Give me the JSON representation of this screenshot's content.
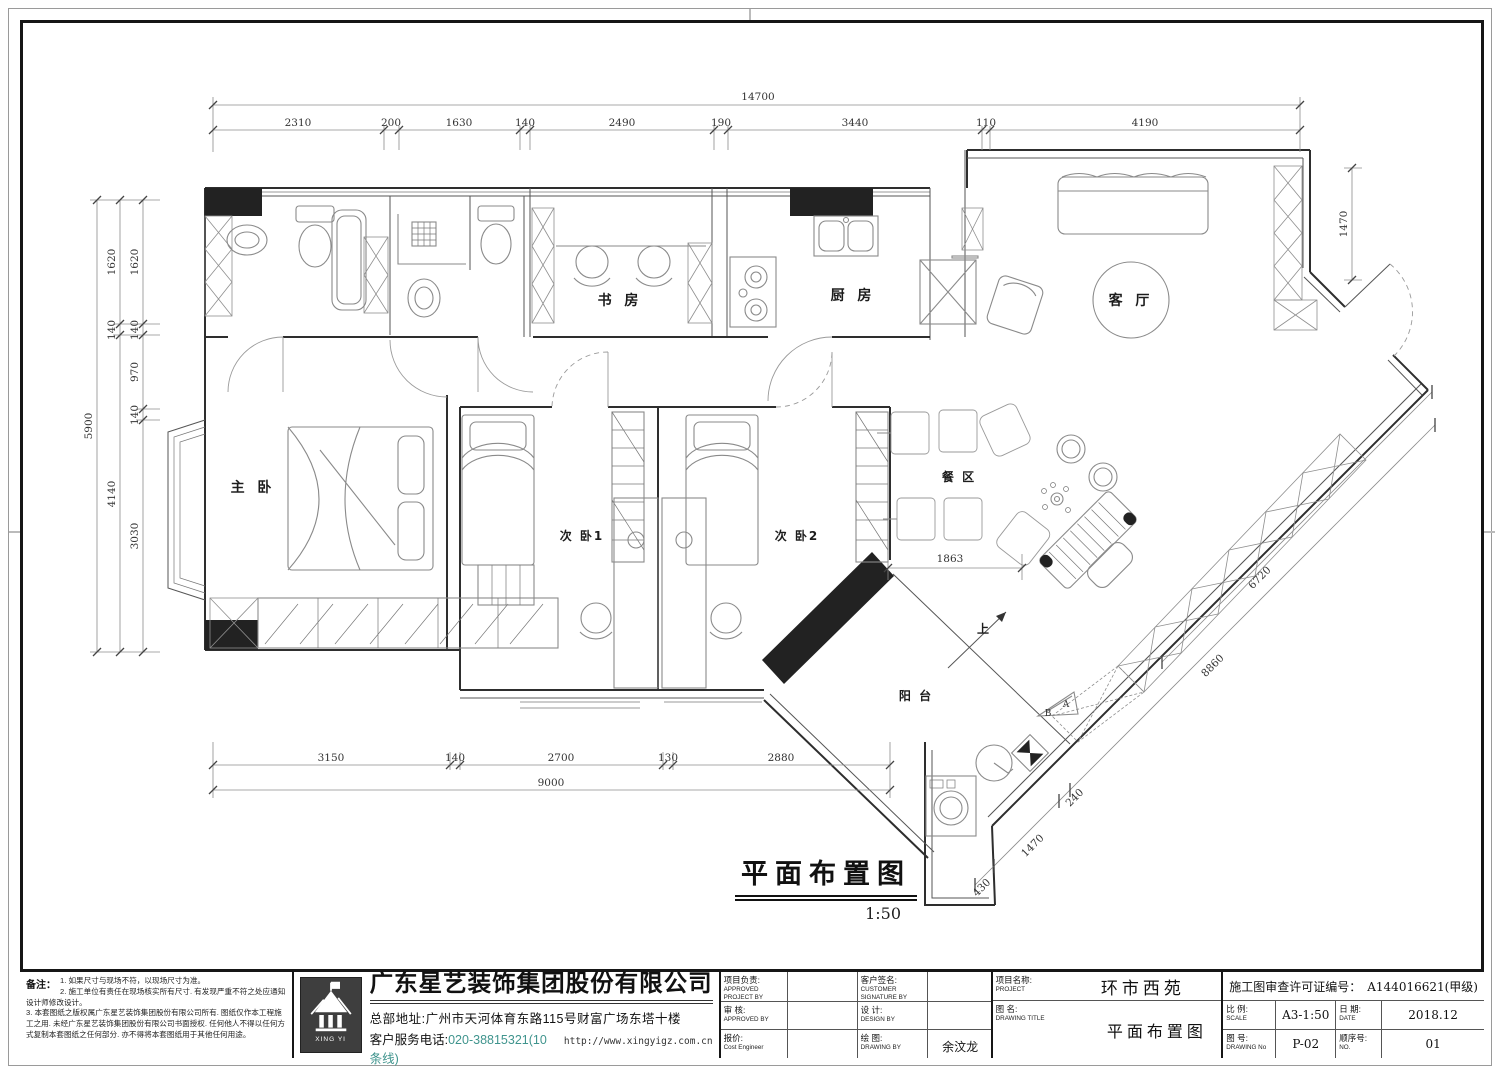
{
  "plan": {
    "title": {
      "text": "平面布置图",
      "scale": "1:50"
    },
    "rooms": {
      "study": "书 房",
      "kitchen": "厨 房",
      "living": "客 厅",
      "master": "主 卧",
      "bedroom1": "次 卧1",
      "bedroom2": "次 卧2",
      "dining": "餐 区",
      "balcony": "阳 台"
    },
    "annotations": {
      "up": "上",
      "marker_a": "A",
      "marker_b": "B"
    },
    "dims": {
      "top_total": "14700",
      "top_segs": [
        "2310",
        "200",
        "1630",
        "140",
        "2490",
        "190",
        "3440",
        "110",
        "4190"
      ],
      "left_total": "5900",
      "left_mid": [
        "1620",
        "140",
        "4140"
      ],
      "left_inner": [
        "1620",
        "140",
        "970",
        "140",
        "3030"
      ],
      "bottom_total": "9000",
      "bottom_segs": [
        "3150",
        "140",
        "2700",
        "130",
        "2880"
      ],
      "right_v": "1470",
      "diag_inner": "6720",
      "diag_outer": "8860",
      "diag_small": [
        "430",
        "1470",
        "240"
      ],
      "dining_width": "1863"
    }
  },
  "notes": {
    "label": "备注：",
    "items": [
      "1. 如果尺寸与现场不符，以现场尺寸为准。",
      "2. 施工单位有责任在现场核实所有尺寸. 有发现严重不符之处应通知设计师修改设计。",
      "3. 本套图纸之版权属广东星艺装饰集团股份有限公司所有. 图纸仅作本工程施工之用. 未经广东星艺装饰集团股份有限公司书面授权. 任何他人不得以任何方式复制本套图纸之任何部分. 亦不得将本套图纸用于其他任何用途。"
    ]
  },
  "company": {
    "name": "广东星艺装饰集团股份有限公司",
    "address": "总部地址:广州市天河体育东路115号财富广场东塔十楼",
    "phone_label": "客户服务电话:",
    "phone": "020-38815321(10条线)",
    "url": "http://www.xingyigz.com.cn",
    "logo_text": "XING YI"
  },
  "titleblock": {
    "col1": [
      {
        "zh": "项目负责:",
        "en": "APPROVED PROJECT BY",
        "val": ""
      },
      {
        "zh": "审 核:",
        "en": "APPROVED BY",
        "val": ""
      },
      {
        "zh": "报价:",
        "en": "Cost Engineer",
        "val": ""
      }
    ],
    "col2": [
      {
        "zh": "客户签名:",
        "en": "CUSTOMER SIGNATURE BY",
        "val": ""
      },
      {
        "zh": "设 计:",
        "en": "DESIGN BY",
        "val": ""
      },
      {
        "zh": "绘 图:",
        "en": "DRAWING BY",
        "val": "余汶龙"
      }
    ],
    "project": {
      "label_zh": "项目名称:",
      "label_en": "PROJECT",
      "value": "环市西苑"
    },
    "drawing": {
      "label_zh": "图 名:",
      "label_en": "DRAWING  TITLE",
      "value": "平面布置图"
    },
    "permit": {
      "label": "施工图审查许可证编号：",
      "value": "A144016621(甲级)"
    },
    "scale": {
      "zh": "比 例:",
      "en": "SCALE",
      "value": "A3-1:50"
    },
    "date": {
      "zh": "日 期:",
      "en": "DATE",
      "value": "2018.12"
    },
    "dwg_no": {
      "zh": "图 号:",
      "en": "DRAWING No",
      "value": "P-02"
    },
    "seq": {
      "zh": "顺序号:",
      "en": "NO.",
      "value": "01"
    }
  }
}
